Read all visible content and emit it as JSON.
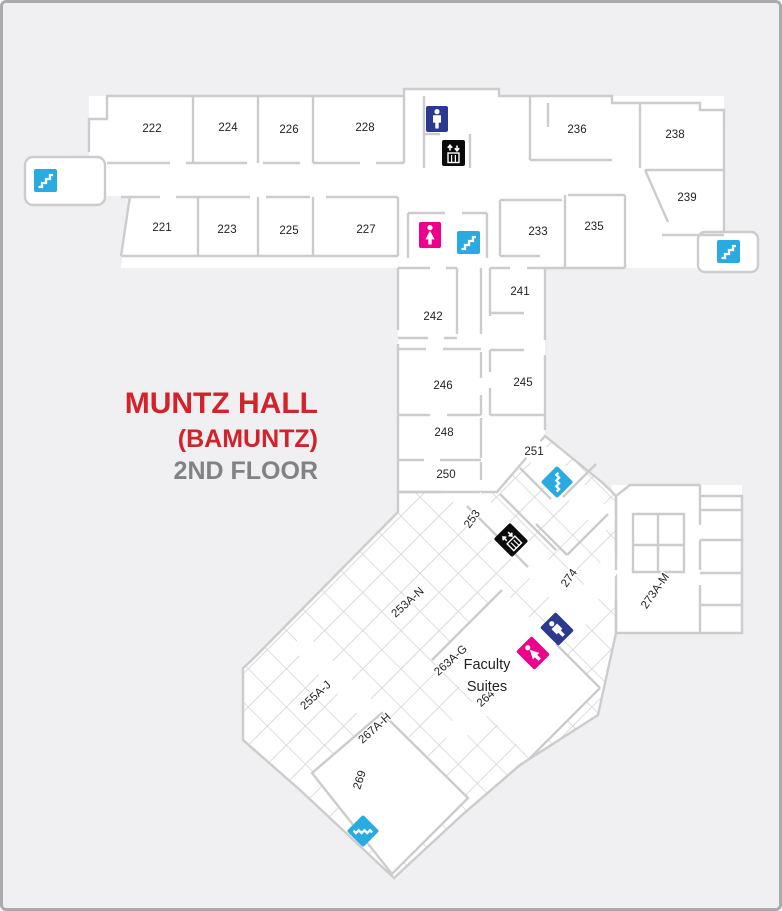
{
  "title": {
    "building": "MUNTZ HALL",
    "code": "(BAMUNTZ)",
    "floor": "2ND FLOOR"
  },
  "colors": {
    "title_red": "#d2232a",
    "floor_gray": "#808285",
    "wall": "#cbccce",
    "grid": "#d2d3d5",
    "room_fill": "#ffffff",
    "background": "#f0f0f2",
    "border": "#aaabae",
    "label": "#231f20",
    "stairs": "#29abe2",
    "mens_restroom": "#2b3990",
    "womens_restroom": "#ec008c",
    "elevator": "#0b0b0b"
  },
  "rooms": {
    "r221": "221",
    "r222": "222",
    "r223": "223",
    "r224": "224",
    "r225": "225",
    "r226": "226",
    "r227": "227",
    "r228": "228",
    "r233": "233",
    "r235": "235",
    "r236": "236",
    "r238": "238",
    "r239": "239",
    "r241": "241",
    "r242": "242",
    "r245": "245",
    "r246": "246",
    "r248": "248",
    "r250": "250",
    "r251": "251",
    "r253": "253",
    "r253an": "253A-N",
    "r255aj": "255A-J",
    "r263ag": "263A-G",
    "r264": "264",
    "r267ah": "267A-H",
    "r269": "269",
    "r273am": "273A-M",
    "r274": "274",
    "faculty1": "Faculty",
    "faculty2": "Suites"
  },
  "icons": {
    "stairs": "stairs",
    "mens": "mens-restroom",
    "womens": "womens-restroom",
    "elevator": "elevator"
  }
}
